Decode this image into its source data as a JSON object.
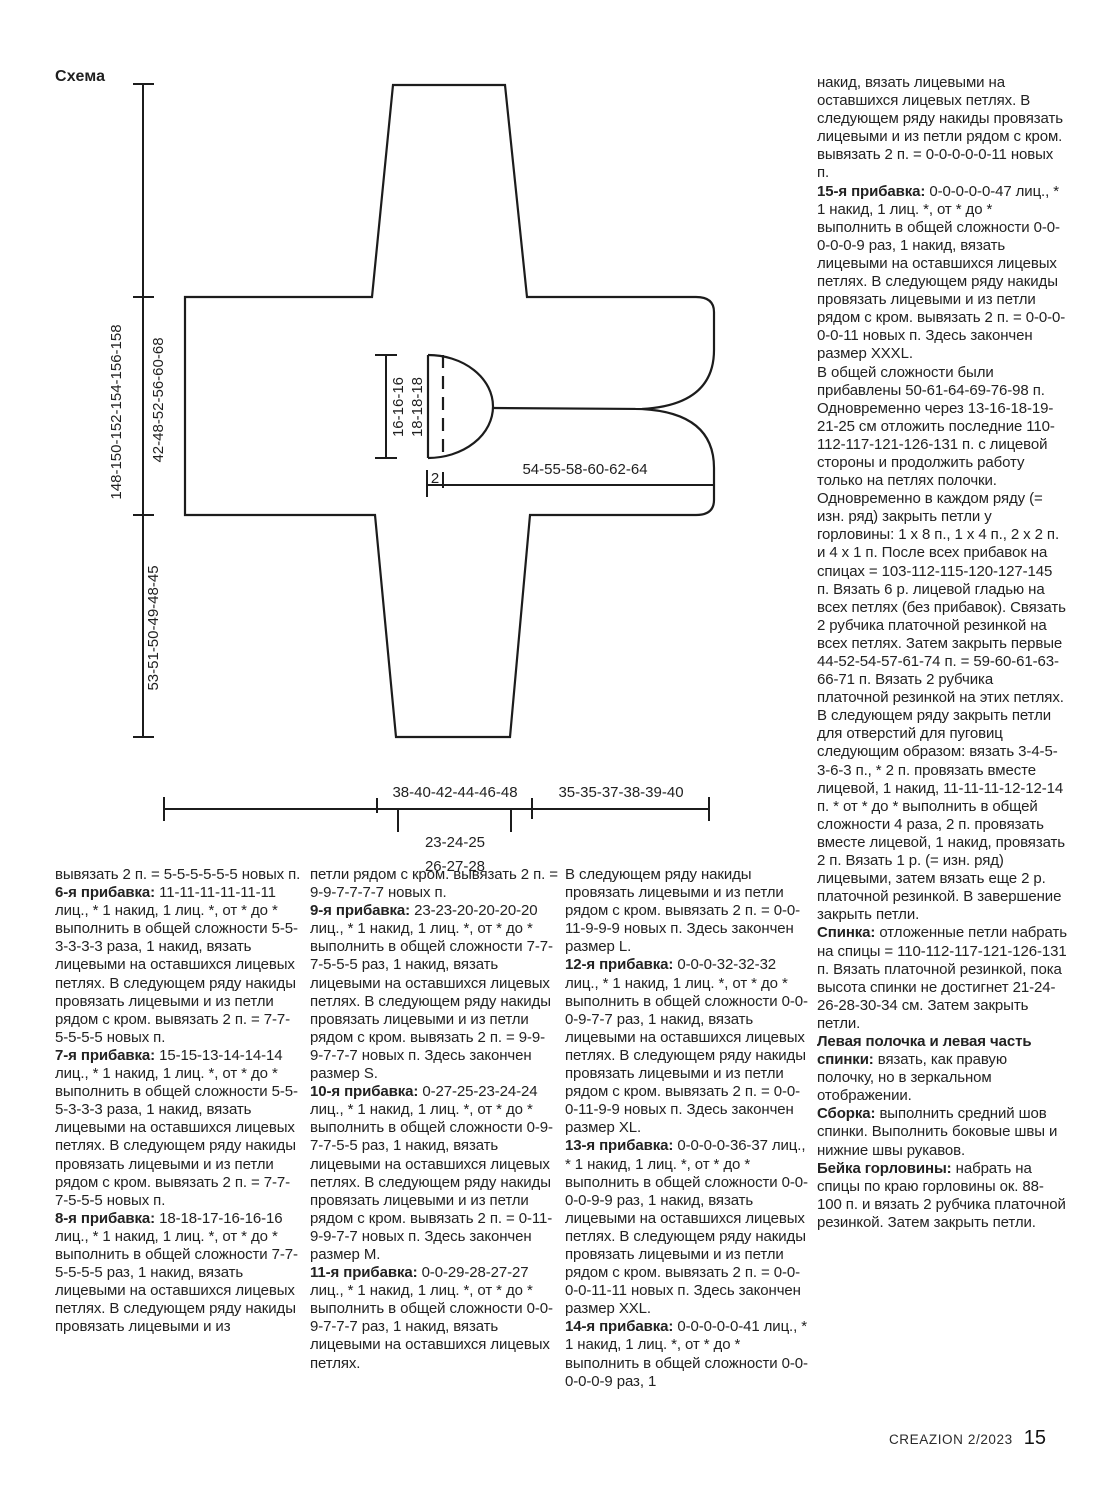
{
  "page": {
    "background": "#ffffff",
    "text_color": "#1f1f1f"
  },
  "diagram": {
    "title": "Схема",
    "labels": {
      "total_width": "148-150-152-154-156-158",
      "body_section": "42-48-52-56-60-68",
      "sleeve_section": "53-51-50-49-48-45",
      "neck_depth_a": "16-16-16",
      "neck_depth_b": "18-18-18",
      "neck_offset": "2",
      "front_edge": "54-55-58-60-62-64",
      "hem_left": "38-40-42-44-46-48",
      "hem_right": "35-35-37-38-39-40",
      "cuff_a": "23-24-25",
      "cuff_b": "26-27-28"
    }
  },
  "columns": {
    "col1": [
      [
        {
          "b": 0,
          "t": "вывязать 2 п. = 5-5-5-5-5-5 новых п."
        }
      ],
      [
        {
          "b": 1,
          "t": "6-я прибавка:"
        },
        {
          "b": 0,
          "t": " 11-11-11-11-11-11 лиц., * 1 накид, 1 лиц. *, от * до * выполнить в общей сложности 5-5-3-3-3-3 раза, 1 накид, вязать лицевыми на оставшихся лицевых петлях. В следующем ряду накиды провязать лицевыми и из петли рядом с кром. вывязать 2 п. = 7-7-5-5-5-5 новых п."
        }
      ],
      [
        {
          "b": 1,
          "t": "7-я прибавка:"
        },
        {
          "b": 0,
          "t": " 15-15-13-14-14-14 лиц., * 1 накид, 1 лиц. *, от * до * выполнить в общей сложности 5-5-5-3-3-3 раза, 1 накид, вязать лицевыми на оставшихся лицевых петлях. В следующем ряду накиды провязать лицевыми и из петли рядом с кром. вывязать 2 п. = 7-7-7-5-5-5 новых п."
        }
      ],
      [
        {
          "b": 1,
          "t": "8-я прибавка:"
        },
        {
          "b": 0,
          "t": " 18-18-17-16-16-16 лиц., * 1 накид, 1 лиц. *, от * до * выполнить в общей сложности 7-7-5-5-5-5 раз, 1 накид, вязать лицевыми на оставшихся лицевых петлях. В следующем ряду накиды провязать лицевыми и из"
        }
      ]
    ],
    "col2": [
      [
        {
          "b": 0,
          "t": "петли рядом с кром. вывязать 2 п. = 9-9-7-7-7-7 новых п."
        }
      ],
      [
        {
          "b": 1,
          "t": "9-я прибавка:"
        },
        {
          "b": 0,
          "t": " 23-23-20-20-20-20 лиц., * 1 накид, 1 лиц. *, от * до * выполнить в общей сложности 7-7-7-5-5-5 раз, 1 накид, вязать лицевыми на оставшихся лицевых петлях. В следующем ряду накиды провязать лицевыми и из петли рядом с кром. вывязать 2 п. = 9-9-9-7-7-7 новых п. Здесь закончен размер S."
        }
      ],
      [
        {
          "b": 1,
          "t": "10-я прибавка:"
        },
        {
          "b": 0,
          "t": " 0-27-25-23-24-24 лиц., * 1 накид, 1 лиц. *, от * до * выполнить в общей сложности 0-9-7-7-5-5 раз, 1 накид, вязать лицевыми на оставшихся лицевых петлях. В следующем ряду накиды провязать лицевыми и из петли рядом с кром. вывязать 2 п. = 0-11-9-9-7-7 новых п. Здесь закончен размер M."
        }
      ],
      [
        {
          "b": 1,
          "t": "11-я прибавка:"
        },
        {
          "b": 0,
          "t": " 0-0-29-28-27-27 лиц., * 1 накид, 1 лиц. *, от * до * выполнить в общей сложности 0-0-9-7-7-7 раз, 1 накид, вязать лицевыми на оставшихся лицевых петлях."
        }
      ]
    ],
    "col3": [
      [
        {
          "b": 0,
          "t": "В следующем ряду накиды провязать лицевыми и из петли рядом с кром. вывязать 2 п. = 0-0-11-9-9-9 новых п. Здесь закончен размер L."
        }
      ],
      [
        {
          "b": 1,
          "t": "12-я прибавка:"
        },
        {
          "b": 0,
          "t": " 0-0-0-32-32-32 лиц., * 1 накид, 1 лиц. *, от * до * выполнить в общей сложности 0-0-0-9-7-7 раз, 1 накид, вязать лицевыми на оставшихся лицевых петлях. В следующем ряду накиды провязать лицевыми и из петли рядом с кром. вывязать 2 п. = 0-0-0-11-9-9 новых п. Здесь закончен размер XL."
        }
      ],
      [
        {
          "b": 1,
          "t": "13-я прибавка:"
        },
        {
          "b": 0,
          "t": " 0-0-0-0-36-37 лиц., * 1 накид, 1 лиц. *, от * до * выполнить в общей сложности 0-0-0-0-9-9 раз, 1 накид, вязать лицевыми на оставшихся лицевых петлях. В следующем ряду накиды провязать лицевыми и из петли рядом с кром. вывязать 2 п. = 0-0-0-0-11-11 новых п. Здесь закончен размер XXL."
        }
      ],
      [
        {
          "b": 1,
          "t": "14-я прибавка:"
        },
        {
          "b": 0,
          "t": " 0-0-0-0-0-41 лиц., * 1 накид, 1 лиц. *, от * до * выполнить в общей сложности 0-0-0-0-0-9 раз, 1"
        }
      ]
    ],
    "col4": [
      [
        {
          "b": 0,
          "t": "накид, вязать лицевыми на оставшихся лицевых петлях. В следующем ряду накиды провязать лицевыми и из петли рядом с кром. вывязать 2 п. = 0-0-0-0-0-11 новых п."
        }
      ],
      [
        {
          "b": 1,
          "t": "15-я прибавка:"
        },
        {
          "b": 0,
          "t": " 0-0-0-0-0-47 лиц., * 1 накид, 1 лиц. *, от * до * выполнить в общей сложности 0-0-0-0-0-9 раз, 1 накид, вязать лицевыми на оставшихся лицевых петлях. В следующем ряду накиды провязать лицевыми и из петли рядом с кром. вывязать 2 п. = 0-0-0-0-0-11 новых п. Здесь закончен размер XXXL."
        }
      ],
      [
        {
          "b": 0,
          "t": "В общей сложности были прибавлены 50-61-64-69-76-98 п."
        }
      ],
      [
        {
          "b": 0,
          "t": "Одновременно через 13-16-18-19-21-25 см отложить последние 110-112-117-121-126-131 п. с лицевой стороны и продолжить работу только на петлях полочки. Одновременно в каждом ряду (= изн. ряд) закрыть петли у горловины: 1 х 8 п., 1 х 4 п., 2 х 2 п. и 4 х 1 п. После всех прибавок на спицах = 103-112-115-120-127-145 п. Вязать 6 р. лицевой гладью на всех петлях (без прибавок). Связать 2 рубчика платочной резинкой на всех петлях. Затем закрыть первые 44-52-54-57-61-74 п. = 59-60-61-63-66-71 п. Вязать 2 рубчика платочной резинкой на этих петлях. В следующем ряду закрыть петли для отверстий для пуговиц следующим образом: вязать 3-4-5-3-6-3 п., * 2 п. провязать вместе лицевой, 1 накид, 11-11-11-12-12-14 п. * от * до * выполнить в общей сложности 4 раза, 2 п. провязать вместе лицевой, 1 накид, провязать 2 п. Вязать 1 р. (= изн. ряд) лицевыми, затем вязать еще 2 р. платочной резинкой. В завершение закрыть петли."
        }
      ],
      [
        {
          "b": 1,
          "t": "Спинка:"
        },
        {
          "b": 0,
          "t": " отложенные петли набрать на спицы = 110-112-117-121-126-131 п. Вязать платочной резинкой, пока высота спинки не достигнет 21-24-26-28-30-34 см. Затем закрыть петли."
        }
      ],
      [
        {
          "b": 1,
          "t": "Левая полочка и левая часть спинки:"
        },
        {
          "b": 0,
          "t": " вязать, как правую полочку, но в зеркальном отображении."
        }
      ],
      [
        {
          "b": 1,
          "t": "Сборка:"
        },
        {
          "b": 0,
          "t": " выполнить средний шов спинки. Выполнить боковые швы и нижние швы рукавов."
        }
      ],
      [
        {
          "b": 1,
          "t": "Бейка горловины:"
        },
        {
          "b": 0,
          "t": " набрать на спицы по краю горловины ок. 88-100 п. и вязать 2 рубчика платочной резинкой. Затем закрыть петли."
        }
      ]
    ]
  },
  "footer": {
    "magazine": "CREAZION 2/2023",
    "page_number": "15"
  }
}
